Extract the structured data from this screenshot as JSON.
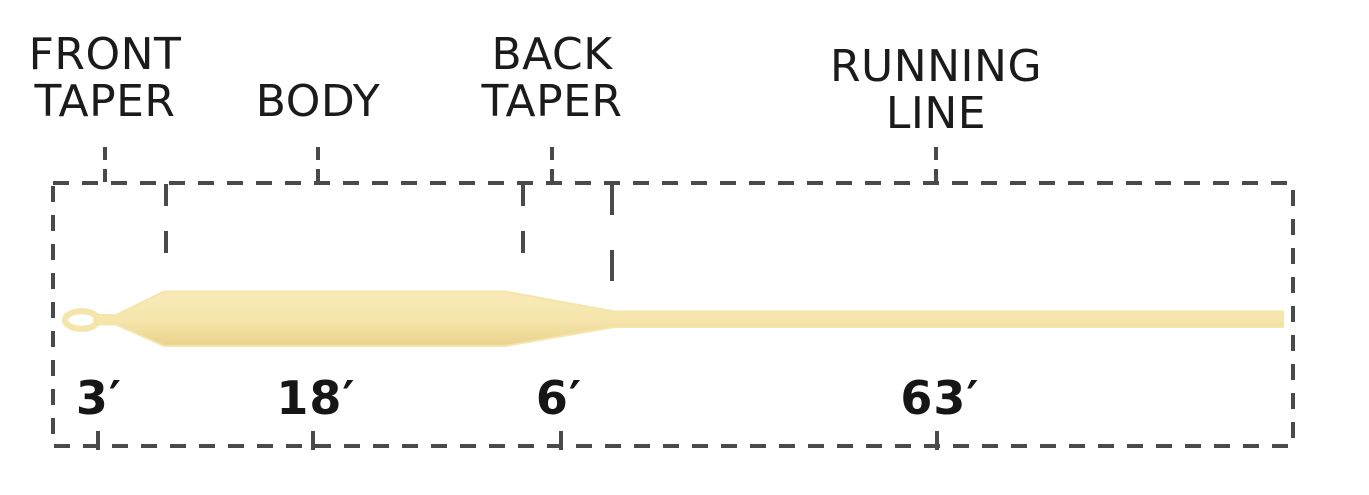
{
  "diagram": {
    "name": "Fly line taper diagram",
    "sections": [
      {
        "id": "front-taper",
        "label_line1": "FRONT",
        "label_line2": "TAPER",
        "length": "3′"
      },
      {
        "id": "body",
        "label_line1": "BODY",
        "label_line2": "",
        "length": "18′"
      },
      {
        "id": "back-taper",
        "label_line1": "BACK",
        "label_line2": "TAPER",
        "length": "6′"
      },
      {
        "id": "running-line",
        "label_line1": "RUNNING",
        "label_line2": "LINE",
        "length": "63′"
      }
    ],
    "colors": {
      "line_fill_light": "#F8EBB9",
      "line_fill": "#F5E5AB",
      "line_fill_shadow": "#E9D28C",
      "dash_stroke": "#4a4a4a",
      "text": "#1b1b1b",
      "background": "#ffffff"
    }
  }
}
